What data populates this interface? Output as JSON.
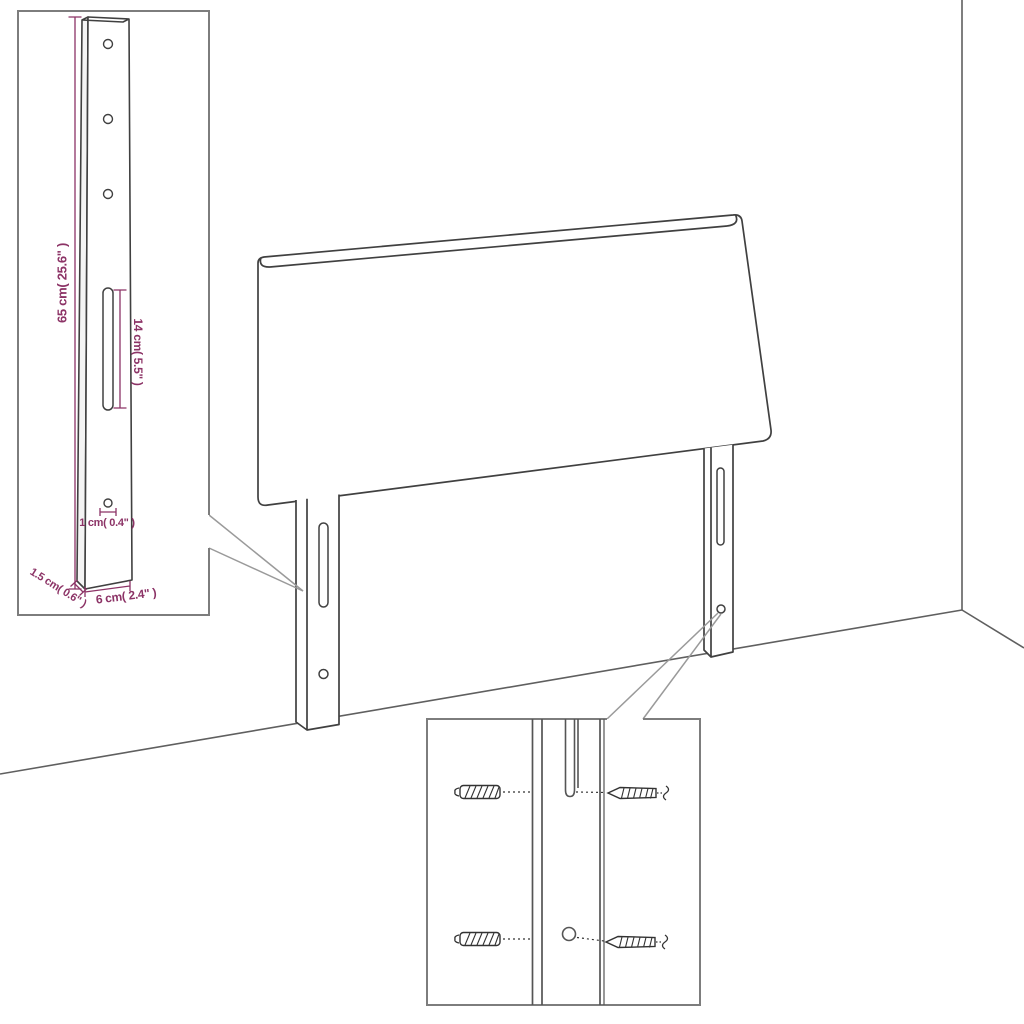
{
  "diagram": {
    "subject": "headboard-with-legs-dimension-diagram",
    "colors": {
      "background": "#ffffff",
      "outline": "#404040",
      "box_border": "#7d7d7d",
      "leader": "#9a9a9a",
      "dimension": "#8c3366"
    },
    "inset_top_left": {
      "part": "mounting-leg-bracket",
      "dimension_labels": {
        "height": "65 cm( 25.6\" )",
        "slot_length": "14 cm( 5.5\" )",
        "hole_diameter": "1 cm( 0.4\" )",
        "thickness": "1.5 cm( 0.6\" )",
        "width": "6 cm( 2.4\" )"
      }
    },
    "inset_bottom": {
      "part": "fastening-detail",
      "components": [
        "wall-plug",
        "wall-plug",
        "screw",
        "screw",
        "slot",
        "hole"
      ]
    }
  }
}
